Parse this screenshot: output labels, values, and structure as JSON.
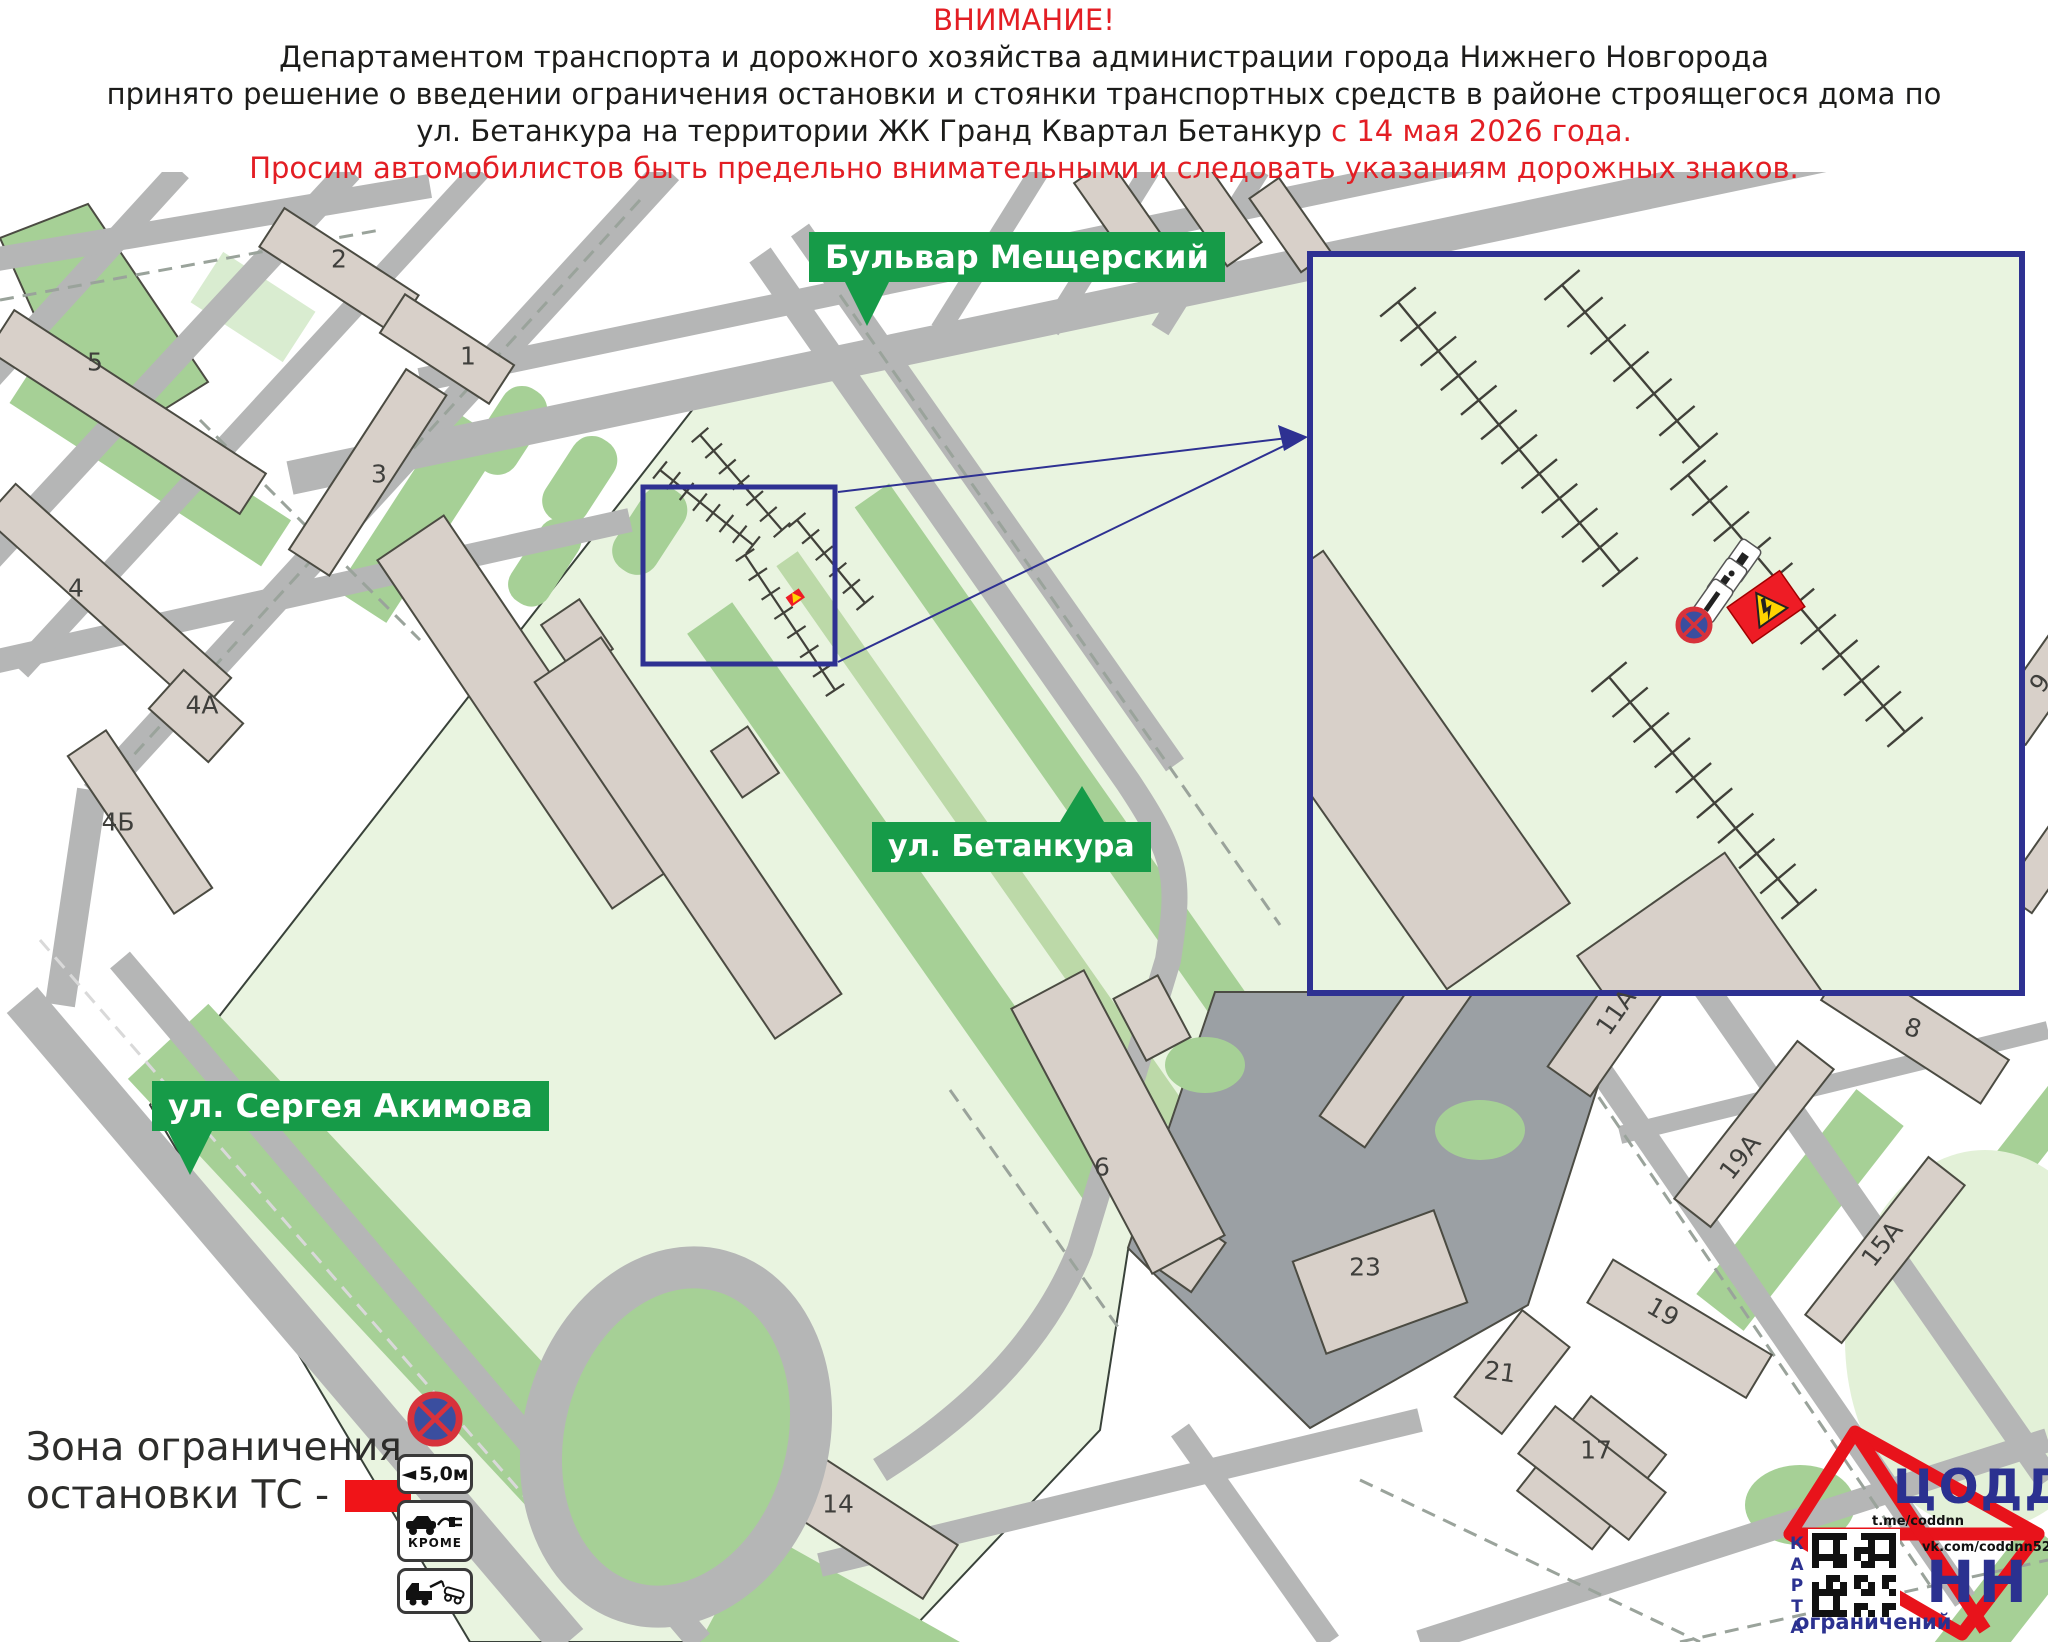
{
  "header": {
    "line1": "ВНИМАНИЕ!",
    "line2": "Департаментом транспорта и дорожного хозяйства администрации города Нижнего Новгорода",
    "line3": "принято решение о введении ограничения остановки и стоянки транспортных средств в районе строящегося дома по",
    "line4_black": "ул. Бетанкура на территории ЖК Гранд Квартал Бетанкур ",
    "line4_red": "с 14 мая 2026 года.",
    "line5": "Просим автомобилистов быть предельно внимательными и следовать указаниям дорожных знаков."
  },
  "map": {
    "street_labels": {
      "meshchersky": "Бульвар Мещерский",
      "betancourt": "ул. Бетанкура",
      "akimova": "ул. Сергея Акимова"
    },
    "building_labels": [
      "2",
      "5",
      "1",
      "3",
      "4",
      "4А",
      "4Б",
      "6",
      "23",
      "14",
      "21",
      "17",
      "19",
      "11А",
      "19А",
      "15А",
      "8",
      "9"
    ],
    "inset": {
      "signs": [
        "no-stopping-sign",
        "tow-truck-plate",
        "electric-car-except-plate",
        "distance-5m-plate",
        "ev-charging-zone-marker"
      ]
    }
  },
  "legend": {
    "line1": "Зона ограничения",
    "line2": "остановки ТС -",
    "sign_distance": "5,0м",
    "sign_except": "КРОМЕ",
    "icons": [
      "no-stopping-sign",
      "distance-plate",
      "electric-car-except-plate",
      "tow-truck-plate"
    ]
  },
  "logo": {
    "org": "ЦОДД",
    "city": "НН",
    "telegram": "t.me/coddnn",
    "vk": "vk.com/coddnn52",
    "map_word": "КАРТА",
    "restrictions_word": "ограничений"
  },
  "colors": {
    "accent_red": "#e31e24",
    "label_green": "#169b48",
    "navy": "#2b3190",
    "map_light_green": "#e9f4e0",
    "lawn_green": "#a6d096",
    "road_gray": "#b5b6b6",
    "construction_gray": "#9ba0a4",
    "building_beige": "#d8d0c9",
    "zone_red": "#ee1c25"
  }
}
